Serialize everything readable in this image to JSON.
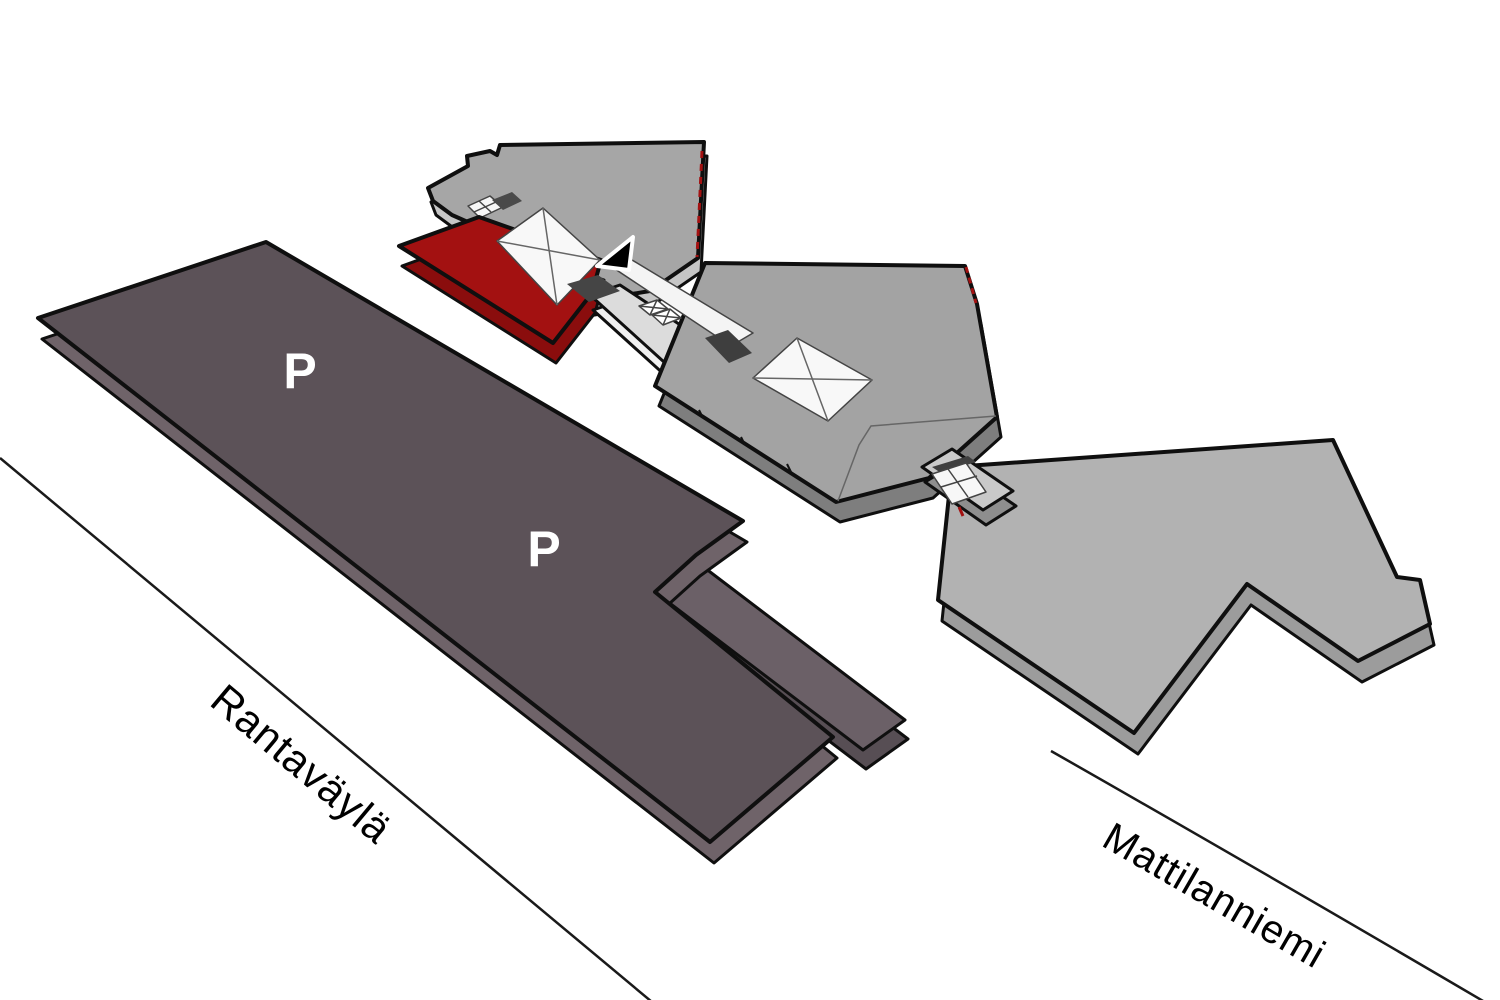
{
  "map": {
    "type": "campus-3d-map",
    "roads": {
      "left_label": "Rantaväylä",
      "right_label": "Mattilanniemi"
    },
    "parking": {
      "label_1": "P",
      "label_2": "P"
    },
    "icons": {
      "location_arrow": "location-arrow-icon"
    },
    "colors": {
      "background": "#ffffff",
      "highlight_red": "#a31111",
      "highlight_red_side": "#8a0d0d",
      "parking_deck": "#5c5258",
      "parking_deck_side": "#6f6369",
      "parking_lower_deck": "#6b6067",
      "parking_lower_deck_side": "#574e54",
      "building_northwest": "#a6a6a6",
      "building_northwest_side": "#c6c6c6",
      "building_middle": "#a3a3a3",
      "building_middle_side": "#7e7e7e",
      "building_east": "#b2b2b2",
      "building_east_side": "#9c9c9c",
      "corridor": "#dcdcdc",
      "corridor_side": "#f0f0f0",
      "connector": "#c9c9c9",
      "connector_side": "#8e8e8e",
      "walkway": "#f4f4f4",
      "skylight": "#f8f8f8",
      "dark_patch": "#3e3e3e",
      "arrow_black": "#000000",
      "road_line": "#1a1a1a",
      "label_text": "#000000",
      "parking_label_text": "#ffffff",
      "exit_dash_red": "#a31111"
    }
  }
}
